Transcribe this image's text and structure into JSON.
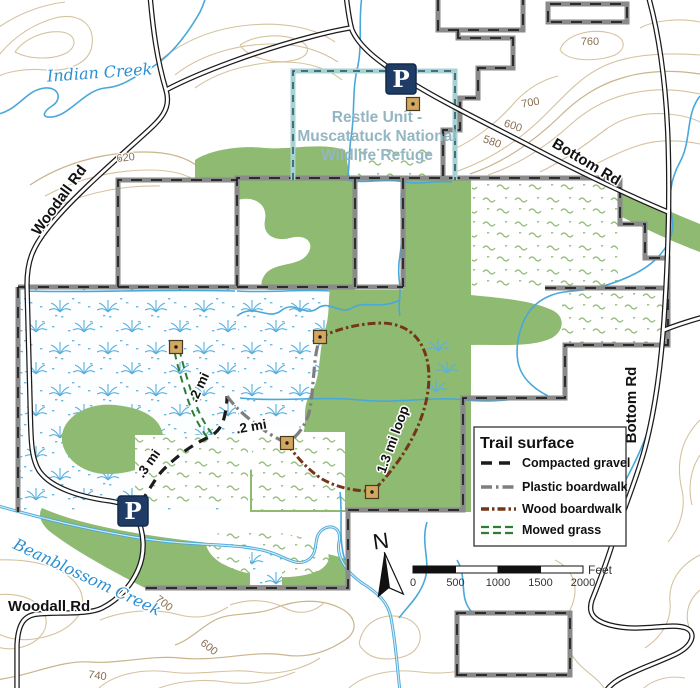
{
  "refuge_label": {
    "line1": "Restle Unit -",
    "line2": "Muscatatuck National",
    "line3": "Wildlife Refuge"
  },
  "roads": {
    "woodall_upper": "Woodall Rd",
    "woodall_lower": "Woodall Rd",
    "bottom_upper": "Bottom Rd",
    "bottom_right": "Bottom Rd"
  },
  "creeks": {
    "indian": "Indian Creek",
    "beanblossom": "Beanblossom Creek"
  },
  "contour_labels": [
    "620",
    "760",
    "700",
    "600",
    "580",
    "700",
    "600",
    "740"
  ],
  "trail_labels": {
    "grass": ".2 mi",
    "plastic": ".2 mi",
    "gravel": ".3 mi",
    "loop": "1.3 mi loop"
  },
  "parking": {
    "symbol": "P"
  },
  "north": {
    "label": "N"
  },
  "legend": {
    "title": "Trail surface",
    "items": [
      {
        "label": "Compacted gravel"
      },
      {
        "label": "Plastic boardwalk"
      },
      {
        "label": "Wood boardwalk"
      },
      {
        "label": "Mowed grass"
      }
    ]
  },
  "scale_bar": {
    "ticks": [
      "0",
      "500",
      "1000",
      "1500",
      "2000"
    ],
    "unit": "Feet"
  },
  "colors": {
    "gravel": "#1c1c1c",
    "plastic": "#7e7e7e",
    "wood": "#74351a",
    "grass": "#2e7d33",
    "water": "#49a8da",
    "forest": "#8fba72",
    "marsh_symbol": "#5bb0de",
    "contour": "#d6c2a0",
    "contour_label": "#8a6e52",
    "boundary": "#8a8a8a",
    "unit_outline": "#a5d3cf",
    "parking_blue": "#1e3c66",
    "marker": "#d2a75f",
    "refuge_text": "#93b6c2",
    "creek_text": "#2b8fd4"
  }
}
